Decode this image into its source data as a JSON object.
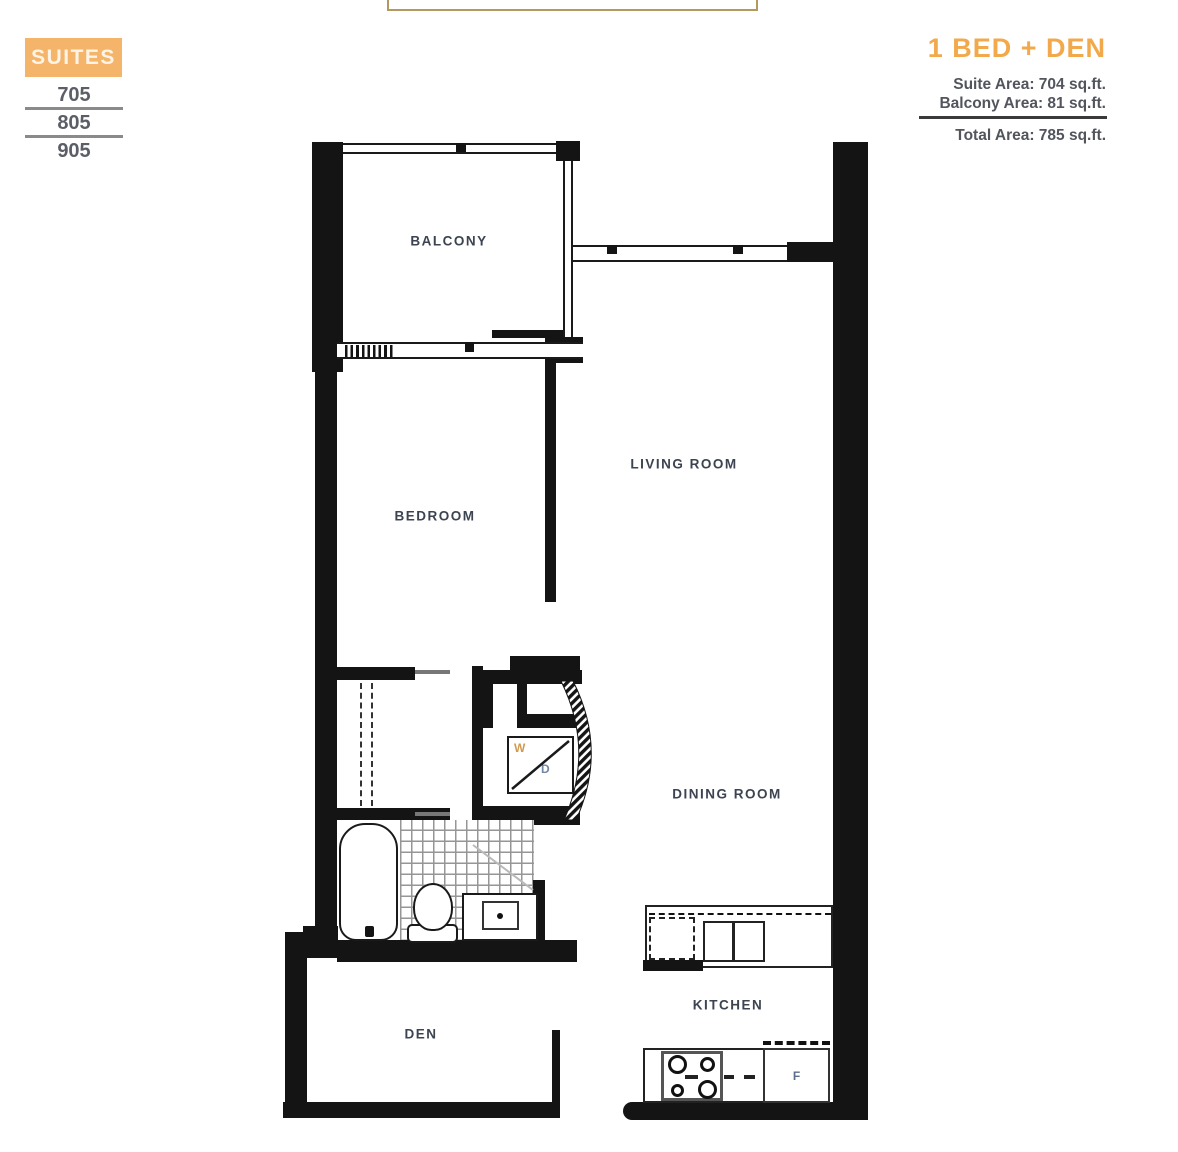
{
  "legend": {
    "suites_label": "SUITES",
    "suite_numbers": [
      "705",
      "805",
      "905"
    ]
  },
  "summary": {
    "plan_name": "1 BED + DEN",
    "suite_area": "Suite Area: 704 sq.ft.",
    "balcony_area": "Balcony Area: 81 sq.ft.",
    "total_area": "Total Area: 785 sq.ft."
  },
  "rooms": {
    "balcony": "BALCONY",
    "bedroom": "BEDROOM",
    "living_room": "LIVING ROOM",
    "dining_room": "DINING ROOM",
    "den": "DEN",
    "kitchen": "KITCHEN"
  },
  "appliances": {
    "washer": "W",
    "dryer": "D",
    "fridge": "F"
  },
  "colors": {
    "accent_orange": "#F2A94C",
    "suites_box_orange": "#F4B469",
    "wall_black": "#141414",
    "room_label_slate": "#3D4451",
    "washer_letter": "#D09A50",
    "dryer_letter": "#7286A8",
    "fridge_letter": "#5D6E8C"
  }
}
